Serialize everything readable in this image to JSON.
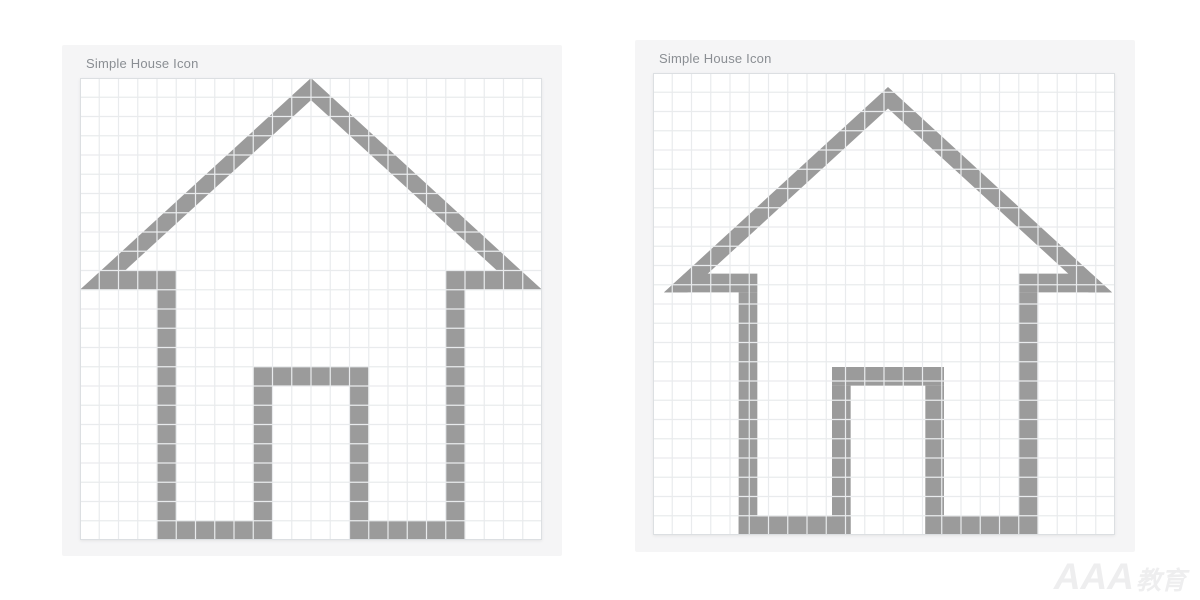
{
  "page": {
    "background": "#ffffff"
  },
  "panels": [
    {
      "title": "Simple House Icon",
      "x": 62,
      "y": 45,
      "width": 500,
      "height": 511,
      "house_placement": {
        "dx": 0,
        "dy": 0,
        "size": 462
      }
    },
    {
      "title": "Simple House Icon",
      "x": 635,
      "y": 40,
      "width": 500,
      "height": 512,
      "house_placement": {
        "dx": 11,
        "dy": 14,
        "size": 448
      }
    }
  ],
  "grid": {
    "columns": 24,
    "rows": 24,
    "size_px": 462,
    "background": "#ffffff",
    "line_color": "#e9ebed",
    "border_color": "#dcdfe2",
    "line_width": 1.2
  },
  "house": {
    "fill": "#9b9b9b",
    "units": 24,
    "polygons": [
      {
        "name": "roof-band",
        "points": [
          [
            0,
            11
          ],
          [
            12,
            0
          ],
          [
            24,
            11
          ],
          [
            22.75,
            11
          ],
          [
            12,
            1.15
          ],
          [
            1.25,
            11
          ]
        ]
      },
      {
        "name": "eave-left",
        "points": [
          [
            1.1,
            10
          ],
          [
            5,
            10
          ],
          [
            5,
            11
          ],
          [
            0,
            11
          ]
        ]
      },
      {
        "name": "eave-right",
        "points": [
          [
            19,
            10
          ],
          [
            22.9,
            10
          ],
          [
            24,
            11
          ],
          [
            19,
            11
          ]
        ]
      },
      {
        "name": "wall-left",
        "points": [
          [
            4,
            11
          ],
          [
            5,
            11
          ],
          [
            5,
            24
          ],
          [
            4,
            24
          ]
        ]
      },
      {
        "name": "wall-right",
        "points": [
          [
            19,
            11
          ],
          [
            20,
            11
          ],
          [
            20,
            24
          ],
          [
            19,
            24
          ]
        ]
      },
      {
        "name": "floor-left",
        "points": [
          [
            4,
            23
          ],
          [
            10,
            23
          ],
          [
            10,
            24
          ],
          [
            4,
            24
          ]
        ]
      },
      {
        "name": "floor-right",
        "points": [
          [
            14,
            23
          ],
          [
            20,
            23
          ],
          [
            20,
            24
          ],
          [
            14,
            24
          ]
        ]
      },
      {
        "name": "door-top",
        "points": [
          [
            9,
            15
          ],
          [
            15,
            15
          ],
          [
            15,
            16
          ],
          [
            9,
            16
          ]
        ]
      },
      {
        "name": "door-left",
        "points": [
          [
            9,
            16
          ],
          [
            10,
            16
          ],
          [
            10,
            24
          ],
          [
            9,
            24
          ]
        ]
      },
      {
        "name": "door-right",
        "points": [
          [
            14,
            16
          ],
          [
            15,
            16
          ],
          [
            15,
            24
          ],
          [
            14,
            24
          ]
        ]
      }
    ]
  },
  "watermark": {
    "text": "AAA",
    "suffix": "教育",
    "color": "#eeeeef"
  }
}
